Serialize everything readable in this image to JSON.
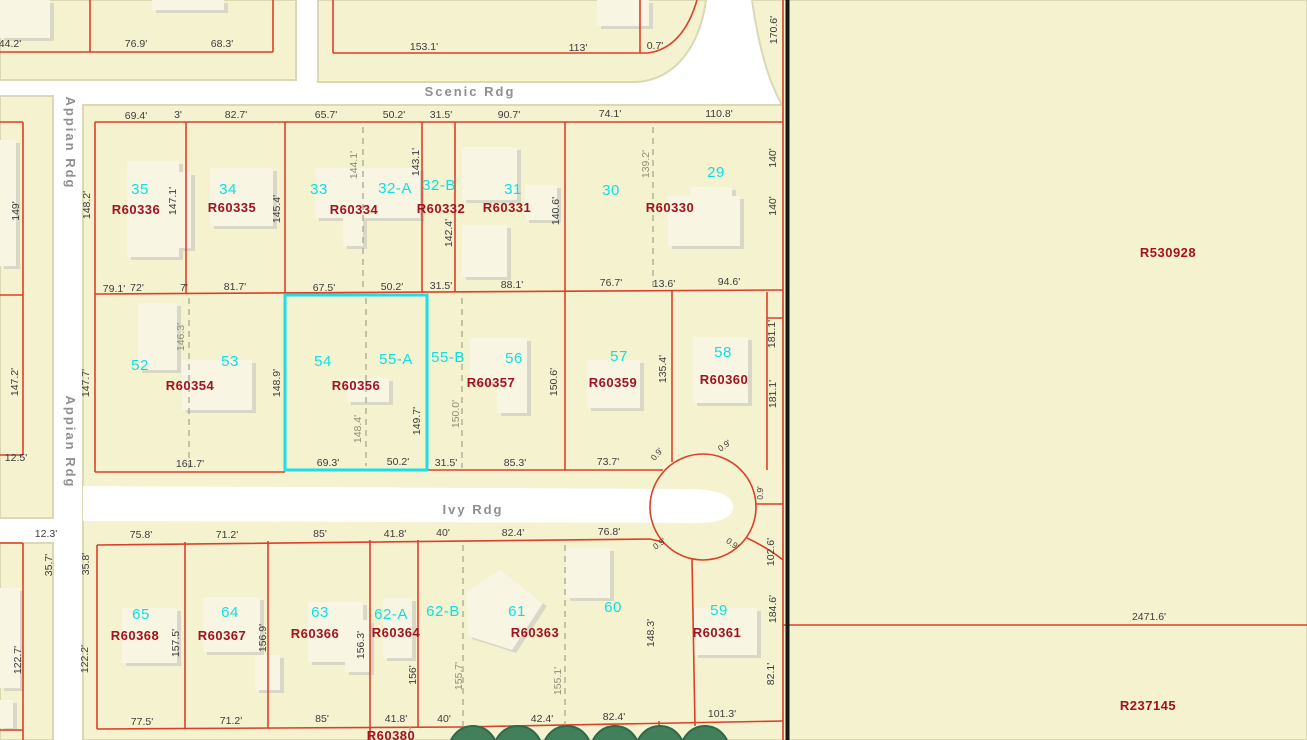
{
  "title": "Parcel map view",
  "selection": {
    "lots": [
      "54",
      "55-A"
    ],
    "parcel_id": "R60356"
  },
  "colors": {
    "parcel_fill": "#f5f2cf",
    "parcel_edge": "#dbd8b4",
    "road": "#ffffff",
    "boundary_red": "#dc402a",
    "selection_cyan": "#1edfe6",
    "lot_number_cyan": "#0ce0e6",
    "parcel_id_red": "#a2121f",
    "dimension_text": "#3c3c3c",
    "dashed_line": "#a8a88a",
    "street_text": "#8f8f8f",
    "section_line_black": "#161616",
    "building_fill": "#f8f5e3",
    "building_shadow": "#d9d7c6",
    "tree_green": "#41805a"
  },
  "labels": {
    "streets": [
      {
        "t": "Scenic Rdg",
        "x": 470,
        "y": 96
      },
      {
        "t": "Ivy Rdg",
        "x": 473,
        "y": 514
      },
      {
        "t": "Appian Rdg",
        "x": 66,
        "y": 143,
        "r": 90
      },
      {
        "t": "Appian Rdg",
        "x": 66,
        "y": 442,
        "r": 90
      }
    ],
    "lot_numbers": [
      {
        "t": "35",
        "x": 140,
        "y": 194
      },
      {
        "t": "34",
        "x": 228,
        "y": 194
      },
      {
        "t": "33",
        "x": 319,
        "y": 194
      },
      {
        "t": "32-A",
        "x": 395,
        "y": 193
      },
      {
        "t": "32-B",
        "x": 439,
        "y": 190
      },
      {
        "t": "31",
        "x": 513,
        "y": 194
      },
      {
        "t": "30",
        "x": 611,
        "y": 195
      },
      {
        "t": "29",
        "x": 716,
        "y": 177
      },
      {
        "t": "52",
        "x": 140,
        "y": 370
      },
      {
        "t": "53",
        "x": 230,
        "y": 366
      },
      {
        "t": "54",
        "x": 323,
        "y": 366
      },
      {
        "t": "55-A",
        "x": 396,
        "y": 364
      },
      {
        "t": "55-B",
        "x": 448,
        "y": 362
      },
      {
        "t": "56",
        "x": 514,
        "y": 363
      },
      {
        "t": "57",
        "x": 619,
        "y": 361
      },
      {
        "t": "58",
        "x": 723,
        "y": 357
      },
      {
        "t": "65",
        "x": 141,
        "y": 619
      },
      {
        "t": "64",
        "x": 230,
        "y": 617
      },
      {
        "t": "63",
        "x": 320,
        "y": 617
      },
      {
        "t": "62-A",
        "x": 391,
        "y": 619
      },
      {
        "t": "62-B",
        "x": 443,
        "y": 616
      },
      {
        "t": "61",
        "x": 517,
        "y": 616
      },
      {
        "t": "60",
        "x": 613,
        "y": 612
      },
      {
        "t": "59",
        "x": 719,
        "y": 615
      }
    ],
    "parcel_ids": [
      {
        "t": "R60336",
        "x": 136,
        "y": 214
      },
      {
        "t": "R60335",
        "x": 232,
        "y": 212
      },
      {
        "t": "R60334",
        "x": 354,
        "y": 214
      },
      {
        "t": "R60332",
        "x": 441,
        "y": 213
      },
      {
        "t": "R60331",
        "x": 507,
        "y": 212
      },
      {
        "t": "R60330",
        "x": 670,
        "y": 212
      },
      {
        "t": "R60354",
        "x": 190,
        "y": 390
      },
      {
        "t": "R60356",
        "x": 356,
        "y": 390
      },
      {
        "t": "R60357",
        "x": 491,
        "y": 387
      },
      {
        "t": "R60359",
        "x": 613,
        "y": 387
      },
      {
        "t": "R60360",
        "x": 724,
        "y": 384
      },
      {
        "t": "R60368",
        "x": 135,
        "y": 640
      },
      {
        "t": "R60367",
        "x": 222,
        "y": 640
      },
      {
        "t": "R60366",
        "x": 315,
        "y": 638
      },
      {
        "t": "R60364",
        "x": 396,
        "y": 637
      },
      {
        "t": "R60363",
        "x": 535,
        "y": 637
      },
      {
        "t": "R60361",
        "x": 717,
        "y": 637
      },
      {
        "t": "R60380",
        "x": 391,
        "y": 740
      },
      {
        "t": "R530928",
        "x": 1168,
        "y": 257
      },
      {
        "t": "R237145",
        "x": 1148,
        "y": 710
      }
    ],
    "dimensions": [
      {
        "t": "44.2'",
        "x": 10,
        "y": 47
      },
      {
        "t": "76.9'",
        "x": 136,
        "y": 47
      },
      {
        "t": "68.3'",
        "x": 222,
        "y": 47
      },
      {
        "t": "153.1'",
        "x": 424,
        "y": 50
      },
      {
        "t": "113'",
        "x": 578,
        "y": 51
      },
      {
        "t": "0.7'",
        "x": 655,
        "y": 49
      },
      {
        "t": "69.4'",
        "x": 136,
        "y": 119
      },
      {
        "t": "3'",
        "x": 178,
        "y": 118
      },
      {
        "t": "82.7'",
        "x": 236,
        "y": 118
      },
      {
        "t": "65.7'",
        "x": 326,
        "y": 118
      },
      {
        "t": "50.2'",
        "x": 394,
        "y": 118
      },
      {
        "t": "31.5'",
        "x": 441,
        "y": 118
      },
      {
        "t": "90.7'",
        "x": 509,
        "y": 118
      },
      {
        "t": "74.1'",
        "x": 610,
        "y": 117
      },
      {
        "t": "110.8'",
        "x": 719,
        "y": 117
      },
      {
        "t": "79.1'",
        "x": 114,
        "y": 292
      },
      {
        "t": "72'",
        "x": 137,
        "y": 291
      },
      {
        "t": "7'",
        "x": 184,
        "y": 291
      },
      {
        "t": "81.7'",
        "x": 235,
        "y": 290
      },
      {
        "t": "67.5'",
        "x": 324,
        "y": 291
      },
      {
        "t": "50.2'",
        "x": 392,
        "y": 290
      },
      {
        "t": "31.5'",
        "x": 441,
        "y": 289
      },
      {
        "t": "88.1'",
        "x": 512,
        "y": 288
      },
      {
        "t": "76.7'",
        "x": 611,
        "y": 286
      },
      {
        "t": "13.6'",
        "x": 664,
        "y": 287
      },
      {
        "t": "94.6'",
        "x": 729,
        "y": 285
      },
      {
        "t": "161.7'",
        "x": 190,
        "y": 467
      },
      {
        "t": "69.3'",
        "x": 328,
        "y": 466
      },
      {
        "t": "50.2'",
        "x": 398,
        "y": 465
      },
      {
        "t": "31.5'",
        "x": 446,
        "y": 466
      },
      {
        "t": "85.3'",
        "x": 515,
        "y": 466
      },
      {
        "t": "73.7'",
        "x": 608,
        "y": 465
      },
      {
        "t": "75.8'",
        "x": 141,
        "y": 538
      },
      {
        "t": "71.2'",
        "x": 227,
        "y": 538
      },
      {
        "t": "85'",
        "x": 320,
        "y": 537
      },
      {
        "t": "41.8'",
        "x": 395,
        "y": 537
      },
      {
        "t": "40'",
        "x": 443,
        "y": 536
      },
      {
        "t": "82.4'",
        "x": 513,
        "y": 536
      },
      {
        "t": "76.8'",
        "x": 609,
        "y": 535
      },
      {
        "t": "77.5'",
        "x": 142,
        "y": 725
      },
      {
        "t": "71.2'",
        "x": 231,
        "y": 724
      },
      {
        "t": "85'",
        "x": 322,
        "y": 722
      },
      {
        "t": "41.8'",
        "x": 396,
        "y": 722
      },
      {
        "t": "40'",
        "x": 444,
        "y": 722
      },
      {
        "t": "42.4'",
        "x": 542,
        "y": 722
      },
      {
        "t": "82.4'",
        "x": 614,
        "y": 720
      },
      {
        "t": "101.3'",
        "x": 722,
        "y": 717
      },
      {
        "t": "12.5'",
        "x": 16,
        "y": 461
      },
      {
        "t": "12.3'",
        "x": 46,
        "y": 537
      },
      {
        "t": "2471.6'",
        "x": 1149,
        "y": 620
      },
      {
        "t": "148.2'",
        "x": 90,
        "y": 205,
        "r": -90
      },
      {
        "t": "147.1'",
        "x": 176,
        "y": 201,
        "r": -90
      },
      {
        "t": "145.4'",
        "x": 280,
        "y": 209,
        "r": -90
      },
      {
        "t": "143.1'",
        "x": 419,
        "y": 162,
        "r": -90
      },
      {
        "t": "142.4'",
        "x": 452,
        "y": 233,
        "r": -90
      },
      {
        "t": "140.6'",
        "x": 559,
        "y": 211,
        "r": -90
      },
      {
        "t": "140'",
        "x": 776,
        "y": 158,
        "r": -90
      },
      {
        "t": "140'",
        "x": 776,
        "y": 206,
        "r": -90
      },
      {
        "t": "170.6'",
        "x": 777,
        "y": 30,
        "r": -90
      },
      {
        "t": "147.7'",
        "x": 89,
        "y": 383,
        "r": -90
      },
      {
        "t": "148.9'",
        "x": 280,
        "y": 383,
        "r": -90
      },
      {
        "t": "149.7'",
        "x": 420,
        "y": 421,
        "r": -90
      },
      {
        "t": "150.6'",
        "x": 557,
        "y": 382,
        "r": -90
      },
      {
        "t": "135.4'",
        "x": 666,
        "y": 369,
        "r": -90
      },
      {
        "t": "181.1'",
        "x": 775,
        "y": 334,
        "r": -90
      },
      {
        "t": "181.1'",
        "x": 776,
        "y": 394,
        "r": -90
      },
      {
        "t": "149'",
        "x": 19,
        "y": 211,
        "r": -90
      },
      {
        "t": "147.2'",
        "x": 18,
        "y": 382,
        "r": -90
      },
      {
        "t": "35.7'",
        "x": 52,
        "y": 565,
        "r": -90
      },
      {
        "t": "122.7'",
        "x": 21,
        "y": 660,
        "r": -90
      },
      {
        "t": "35.8'",
        "x": 89,
        "y": 564,
        "r": -90
      },
      {
        "t": "122.2'",
        "x": 88,
        "y": 659,
        "r": -90
      },
      {
        "t": "157.5'",
        "x": 179,
        "y": 643,
        "r": -90
      },
      {
        "t": "156.9'",
        "x": 266,
        "y": 638,
        "r": -90
      },
      {
        "t": "156.3'",
        "x": 364,
        "y": 645,
        "r": -90
      },
      {
        "t": "156'",
        "x": 416,
        "y": 675,
        "r": -90
      },
      {
        "t": "148.3'",
        "x": 654,
        "y": 633,
        "r": -90
      },
      {
        "t": "184.6'",
        "x": 776,
        "y": 609,
        "r": -90
      },
      {
        "t": "82.1'",
        "x": 774,
        "y": 674,
        "r": -90
      },
      {
        "t": "102.6'",
        "x": 774,
        "y": 552,
        "r": -90
      }
    ],
    "dashed_dimensions": [
      {
        "t": "144.1'",
        "x": 357,
        "y": 165,
        "r": -90
      },
      {
        "t": "139.2'",
        "x": 649,
        "y": 164,
        "r": -90
      },
      {
        "t": "146.3'",
        "x": 184,
        "y": 337,
        "r": -90
      },
      {
        "t": "148.4'",
        "x": 361,
        "y": 429,
        "r": -90
      },
      {
        "t": "150.0'",
        "x": 459,
        "y": 414,
        "r": -90
      },
      {
        "t": "155.7'",
        "x": 462,
        "y": 676,
        "r": -90
      },
      {
        "t": "155.1'",
        "x": 561,
        "y": 681,
        "r": -90
      }
    ],
    "small_dimensions": [
      {
        "t": "0.9'",
        "x": 659,
        "y": 456,
        "r": -50
      },
      {
        "t": "0.9'",
        "x": 726,
        "y": 448,
        "r": -35
      },
      {
        "t": "0.9'",
        "x": 763,
        "y": 493,
        "r": -90
      },
      {
        "t": "0.9'",
        "x": 731,
        "y": 546,
        "r": 35
      },
      {
        "t": "0.9'",
        "x": 661,
        "y": 546,
        "r": -35
      }
    ]
  }
}
